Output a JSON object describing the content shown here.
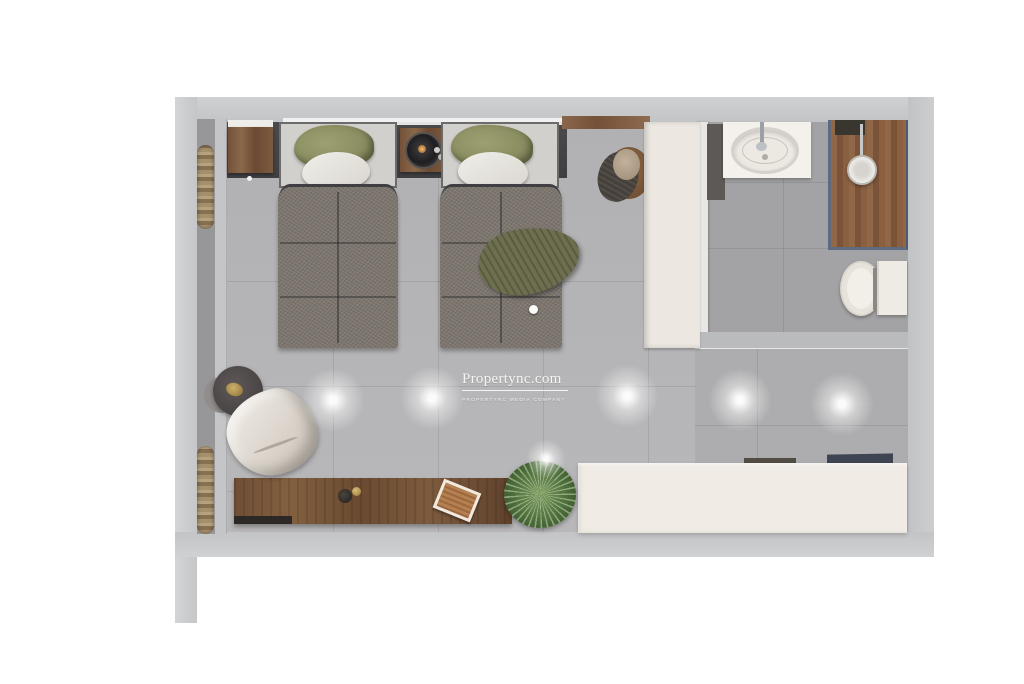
{
  "watermark": {
    "title": "Propertync.com",
    "tagline": "PROPERTYNC MEDIA COMPANY"
  },
  "palette": {
    "background": "#ffffff",
    "wall": "#c9cacc",
    "bedroom_floor": "#b4b4b6",
    "bathroom_floor": "#a3a3a5",
    "headboard_panel": "#454547",
    "wood_furniture": "#7a583e",
    "pillow_green": "#8f9165",
    "blanket_grey": "#7d766f",
    "cream_furniture": "#efeae3",
    "shower_wood": "#8a6243",
    "shower_frame": "#5e6a80",
    "plant_green": "#4f7440",
    "entry_threshold": "#3e4452",
    "curtain_gold": "#a5906c"
  }
}
